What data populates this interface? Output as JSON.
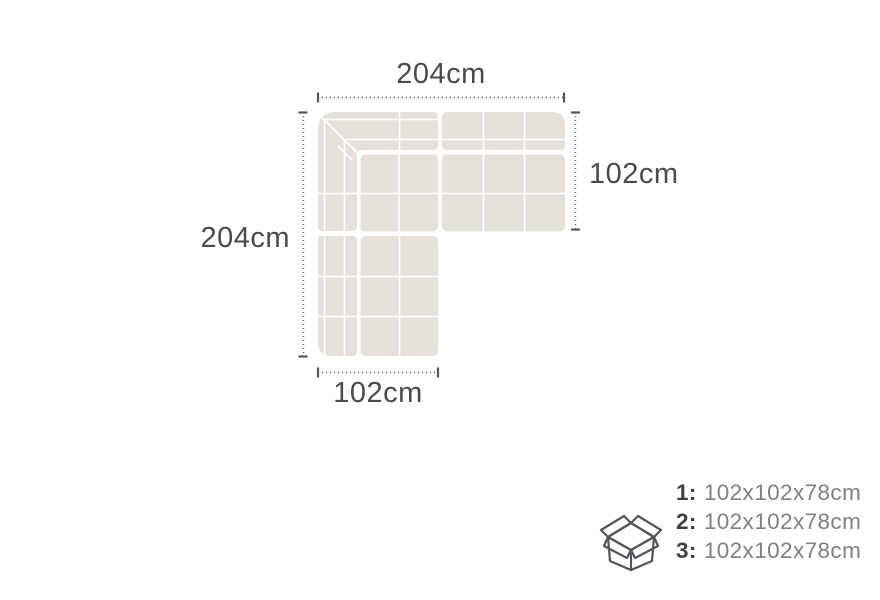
{
  "diagram": {
    "dim_top": {
      "label": "204cm"
    },
    "dim_left": {
      "label": "204cm"
    },
    "dim_right": {
      "label": "102cm"
    },
    "dim_bottom": {
      "label": "102cm"
    },
    "colors": {
      "sofa_fill": "#E5E0DA",
      "seam": "#FFFFFF",
      "dim_line": "#55555A",
      "label_text": "#4A4A4F",
      "package_number": "#3F3F44",
      "package_value": "#808086"
    }
  },
  "packages": {
    "icon": "open-box-icon",
    "items": [
      {
        "number": "1:",
        "size": "102x102x78cm"
      },
      {
        "number": "2:",
        "size": "102x102x78cm"
      },
      {
        "number": "3:",
        "size": "102x102x78cm"
      }
    ]
  }
}
